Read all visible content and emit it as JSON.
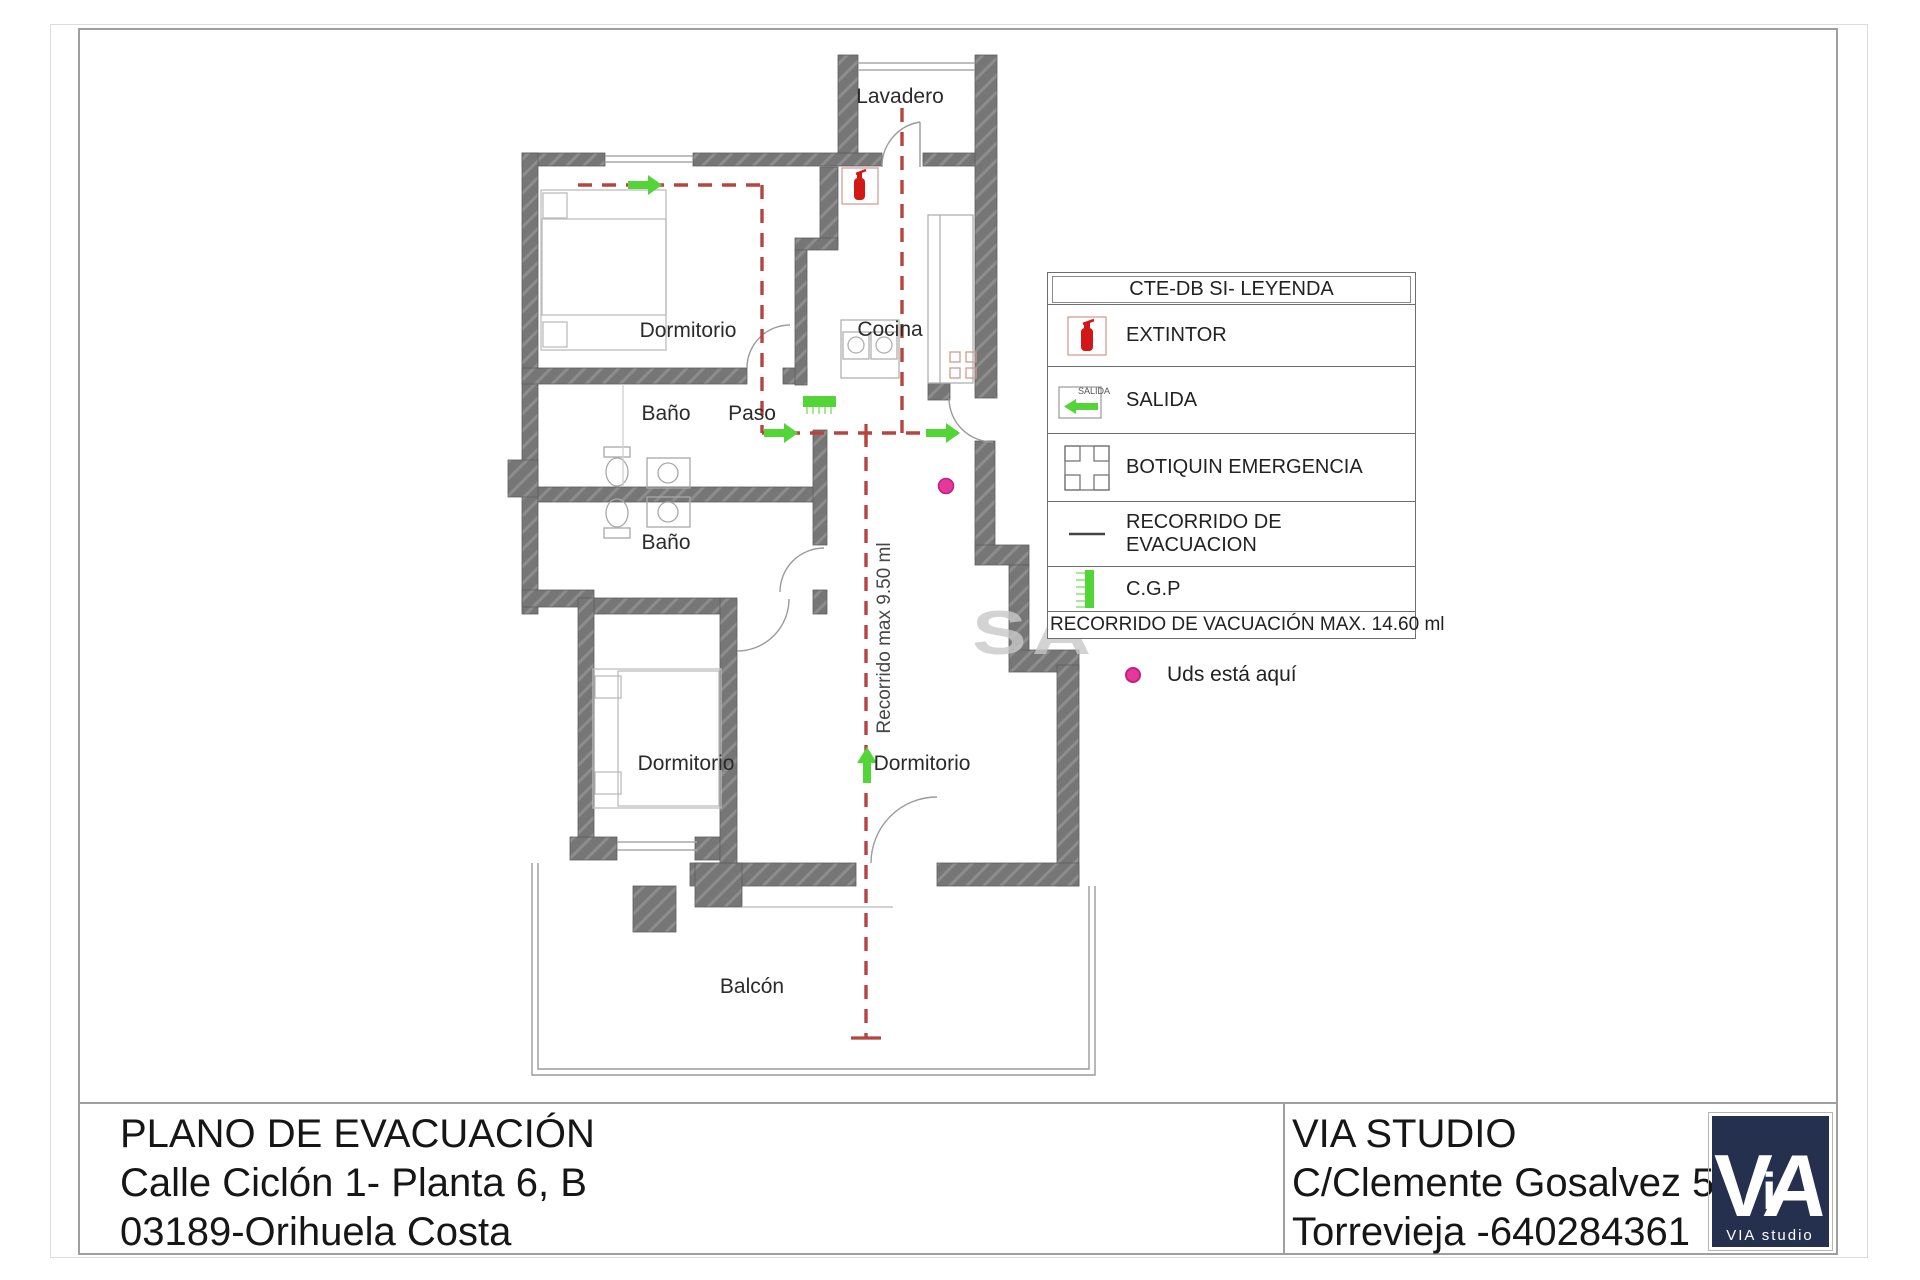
{
  "plan": {
    "room_labels": {
      "lavadero": "Lavadero",
      "dormitorio_top": "Dormitorio",
      "cocina": "Cocina",
      "bano_top": "Baño",
      "paso": "Paso",
      "bano_bottom": "Baño",
      "dormitorio_left": "Dormitorio",
      "dormitorio_right": "Dormitorio",
      "balcon": "Balcón"
    },
    "route_annotation": "Recorrido max 9.50 ml",
    "watermark": "SA"
  },
  "legend": {
    "title": "CTE-DB SI- LEYENDA",
    "items": [
      {
        "id": "extintor",
        "label": "EXTINTOR"
      },
      {
        "id": "salida",
        "label": "SALIDA"
      },
      {
        "id": "botiquin",
        "label": "BOTIQUIN EMERGENCIA"
      },
      {
        "id": "recorrido",
        "label": "RECORRIDO DE EVACUACION"
      },
      {
        "id": "cgp",
        "label": "C.G.P"
      }
    ],
    "salida_icon_text": "SALIDA",
    "footer": "RECORRIDO DE VACUACIÓN MAX. 14.60 ml"
  },
  "you_are_here": {
    "label": "Uds está aquí"
  },
  "title_block": {
    "plan_title": "PLANO DE EVACUACIÓN",
    "address_line1": "Calle Ciclón 1- Planta 6, B",
    "address_line2": "03189-Orihuela Costa",
    "studio_name": "VIA STUDIO",
    "studio_address": "C/Clemente Gosalvez 59",
    "studio_city_phone": "Torrevieja -640284361",
    "logo_letters": [
      "V",
      "i",
      "A"
    ],
    "logo_caption": "VIA studio"
  },
  "colors": {
    "route_red": "#b5453e",
    "arrow_green": "#53d437",
    "marker_pink": "#e8379b",
    "wall_gray": "#767676",
    "logo_navy": "#25304e"
  }
}
